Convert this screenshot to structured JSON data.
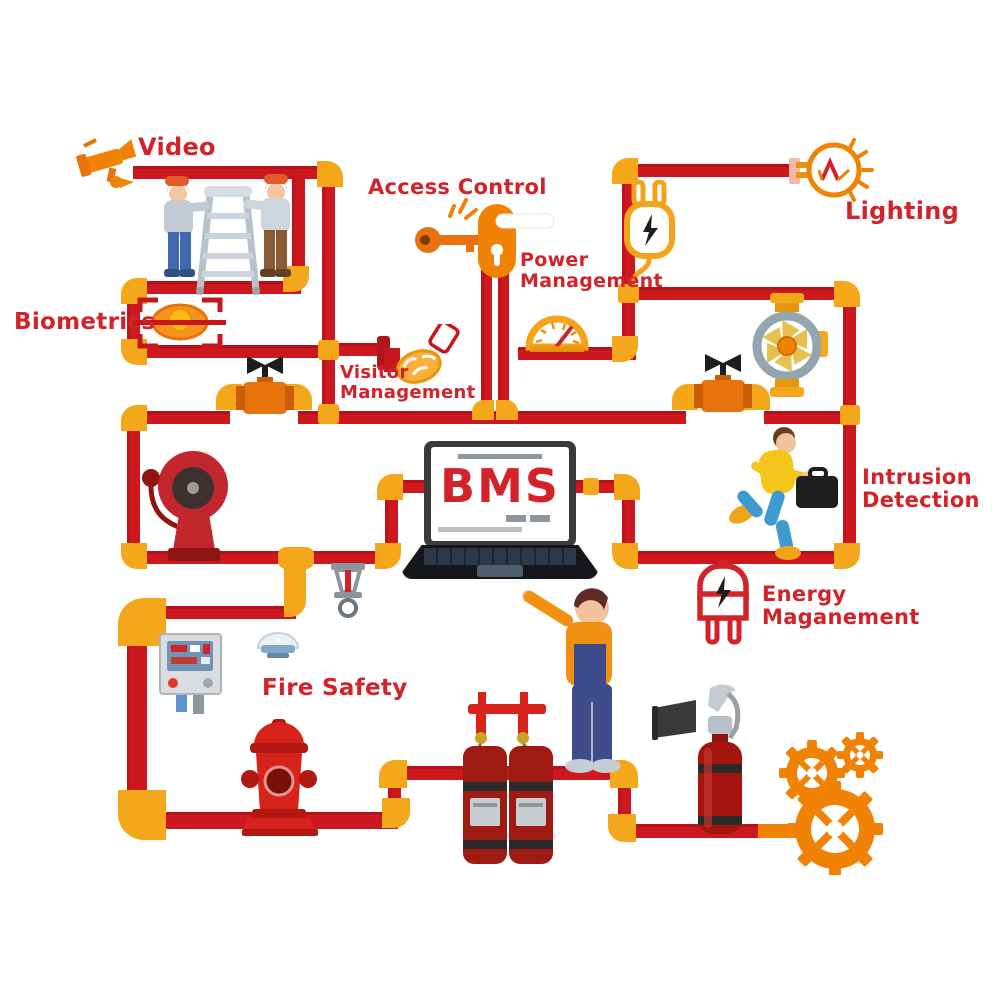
{
  "title": "Building Management System diagram",
  "labels": {
    "video": "Video",
    "biometrics": "Biometrics",
    "access_control": "Access Control",
    "power_management": [
      "Power",
      "Management"
    ],
    "lighting": "Lighting",
    "visitor_management": [
      "Visitor",
      "Management"
    ],
    "intrusion_detection": [
      "Intrusion",
      "Detection"
    ],
    "energy_management": [
      "Energy",
      "Maganement"
    ],
    "fire_safety": "Fire Safety",
    "bms": "BMS"
  },
  "icons": {
    "video": "cctv-camera",
    "biometrics": "eye-scan",
    "access_control": "key-and-door-handle",
    "power_management": "gauge-meter",
    "lighting": "light-bulb",
    "visitor_management": "handshake",
    "intrusion_detection": "running-intruder",
    "energy_management": "power-plug",
    "fire_safety": "alarm-bell, sprinkler, control-panel, smoke-detector, hydrant, suppression-tanks, extinguisher",
    "center": "bms-laptop, technician, gears"
  },
  "colors": {
    "pipe_red": "#CE181F",
    "fitting_yellow": "#F5A71B",
    "label_red": "#D2232A",
    "accent_orange": "#F08306"
  }
}
